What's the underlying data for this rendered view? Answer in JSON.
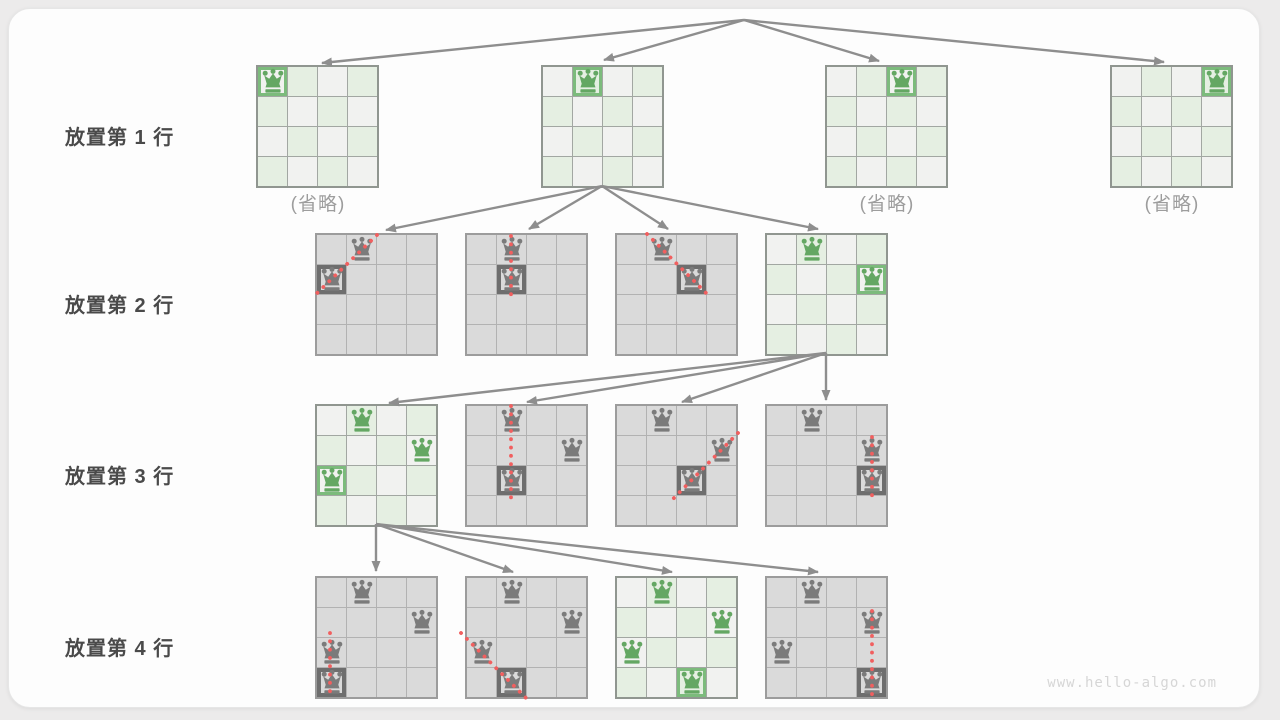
{
  "footer": "www.hello-algo.com",
  "row_labels": [
    {
      "label": "放置第 1 行",
      "y": 112
    },
    {
      "label": "放置第 2 行",
      "y": 280
    },
    {
      "label": "放置第 3 行",
      "y": 451
    },
    {
      "label": "放置第 4 行",
      "y": 623
    }
  ],
  "omitted_text": "(省略)",
  "colors": {
    "green_queen": "#64a763",
    "green_frame": "#7cbb7c",
    "gray_queen": "#7b7b7b",
    "gray_frame": "#6e6e6e",
    "conflict_red": "#f15f5f",
    "arrow_gray": "#8e8e8e",
    "cell_light_green": "#e5efe2",
    "cell_light_gray": "#f1f2f0",
    "cell_dead_gray": "#dadada"
  },
  "boards": [
    {
      "id": "row1-option1",
      "x": 256,
      "y": 65,
      "style": "green",
      "queens": [
        {
          "r": 0,
          "c": 0,
          "framed": true
        }
      ],
      "omitted": true
    },
    {
      "id": "row1-option2",
      "x": 541,
      "y": 65,
      "style": "green",
      "queens": [
        {
          "r": 0,
          "c": 1,
          "framed": true
        }
      ]
    },
    {
      "id": "row1-option3",
      "x": 825,
      "y": 65,
      "style": "green",
      "queens": [
        {
          "r": 0,
          "c": 2,
          "framed": true
        }
      ],
      "omitted": true
    },
    {
      "id": "row1-option4",
      "x": 1110,
      "y": 65,
      "style": "green",
      "queens": [
        {
          "r": 0,
          "c": 3,
          "framed": true
        }
      ],
      "omitted": true
    },
    {
      "id": "row2-option1",
      "x": 315,
      "y": 233,
      "style": "gray",
      "queens": [
        {
          "r": 0,
          "c": 1
        },
        {
          "r": 1,
          "c": 0,
          "framed": true
        }
      ],
      "conflict": {
        "x1": 377,
        "y1": 235,
        "x2": 312,
        "y2": 298
      }
    },
    {
      "id": "row2-option2",
      "x": 465,
      "y": 233,
      "style": "gray",
      "queens": [
        {
          "r": 0,
          "c": 1
        },
        {
          "r": 1,
          "c": 1,
          "framed": true
        }
      ],
      "conflict": {
        "x1": 511,
        "y1": 236,
        "x2": 511,
        "y2": 298
      }
    },
    {
      "id": "row2-option3",
      "x": 615,
      "y": 233,
      "style": "gray",
      "queens": [
        {
          "r": 0,
          "c": 1
        },
        {
          "r": 1,
          "c": 2,
          "framed": true
        }
      ],
      "conflict": {
        "x1": 647,
        "y1": 234,
        "x2": 710,
        "y2": 297
      }
    },
    {
      "id": "row2-option4",
      "x": 765,
      "y": 233,
      "style": "green",
      "queens": [
        {
          "r": 0,
          "c": 1
        },
        {
          "r": 1,
          "c": 3,
          "framed": true
        }
      ]
    },
    {
      "id": "row3-option1",
      "x": 315,
      "y": 404,
      "style": "green",
      "queens": [
        {
          "r": 0,
          "c": 1
        },
        {
          "r": 1,
          "c": 3
        },
        {
          "r": 2,
          "c": 0,
          "framed": true
        }
      ]
    },
    {
      "id": "row3-option2",
      "x": 465,
      "y": 404,
      "style": "gray",
      "queens": [
        {
          "r": 0,
          "c": 1
        },
        {
          "r": 1,
          "c": 3
        },
        {
          "r": 2,
          "c": 1,
          "framed": true
        }
      ],
      "conflict": {
        "x1": 511,
        "y1": 406,
        "x2": 511,
        "y2": 501
      }
    },
    {
      "id": "row3-option3",
      "x": 615,
      "y": 404,
      "style": "gray",
      "queens": [
        {
          "r": 0,
          "c": 1
        },
        {
          "r": 1,
          "c": 3
        },
        {
          "r": 2,
          "c": 2,
          "framed": true
        }
      ],
      "conflict": {
        "x1": 738,
        "y1": 433,
        "x2": 672,
        "y2": 500
      }
    },
    {
      "id": "row3-option4",
      "x": 765,
      "y": 404,
      "style": "gray",
      "queens": [
        {
          "r": 0,
          "c": 1
        },
        {
          "r": 1,
          "c": 3
        },
        {
          "r": 2,
          "c": 3,
          "framed": true
        }
      ],
      "conflict": {
        "x1": 872,
        "y1": 437,
        "x2": 872,
        "y2": 501
      }
    },
    {
      "id": "row4-option1",
      "x": 315,
      "y": 576,
      "style": "gray",
      "queens": [
        {
          "r": 0,
          "c": 1
        },
        {
          "r": 1,
          "c": 3
        },
        {
          "r": 2,
          "c": 0
        },
        {
          "r": 3,
          "c": 0,
          "framed": true
        }
      ],
      "conflict": {
        "x1": 330,
        "y1": 633,
        "x2": 330,
        "y2": 699
      }
    },
    {
      "id": "row4-option2",
      "x": 465,
      "y": 576,
      "style": "gray",
      "queens": [
        {
          "r": 0,
          "c": 1
        },
        {
          "r": 1,
          "c": 3
        },
        {
          "r": 2,
          "c": 0
        },
        {
          "r": 3,
          "c": 1,
          "framed": true
        }
      ],
      "conflict": {
        "x1": 461,
        "y1": 633,
        "x2": 526,
        "y2": 698
      }
    },
    {
      "id": "row4-option3",
      "x": 615,
      "y": 576,
      "style": "green",
      "queens": [
        {
          "r": 0,
          "c": 1
        },
        {
          "r": 1,
          "c": 3
        },
        {
          "r": 2,
          "c": 0
        },
        {
          "r": 3,
          "c": 2,
          "framed": true
        }
      ]
    },
    {
      "id": "row4-option4",
      "x": 765,
      "y": 576,
      "style": "gray",
      "queens": [
        {
          "r": 0,
          "c": 1
        },
        {
          "r": 1,
          "c": 3
        },
        {
          "r": 2,
          "c": 0
        },
        {
          "r": 3,
          "c": 3,
          "framed": true
        }
      ],
      "conflict": {
        "x1": 872,
        "y1": 611,
        "x2": 872,
        "y2": 699
      }
    }
  ],
  "arrows": [
    {
      "from": [
        744,
        20
      ],
      "to": [
        [
          322,
          63
        ],
        [
          604,
          60
        ],
        [
          879,
          61
        ],
        [
          1164,
          62
        ]
      ]
    },
    {
      "from": [
        602,
        186
      ],
      "to": [
        [
          386,
          230
        ],
        [
          529,
          229
        ],
        [
          668,
          229
        ],
        [
          818,
          229
        ]
      ]
    },
    {
      "from": [
        826,
        353
      ],
      "to": [
        [
          389,
          403
        ],
        [
          527,
          402
        ],
        [
          682,
          402
        ],
        [
          826,
          400
        ]
      ]
    },
    {
      "from": [
        376,
        524
      ],
      "to": [
        [
          376,
          571
        ],
        [
          513,
          572
        ],
        [
          672,
          572
        ],
        [
          818,
          572
        ]
      ]
    }
  ]
}
